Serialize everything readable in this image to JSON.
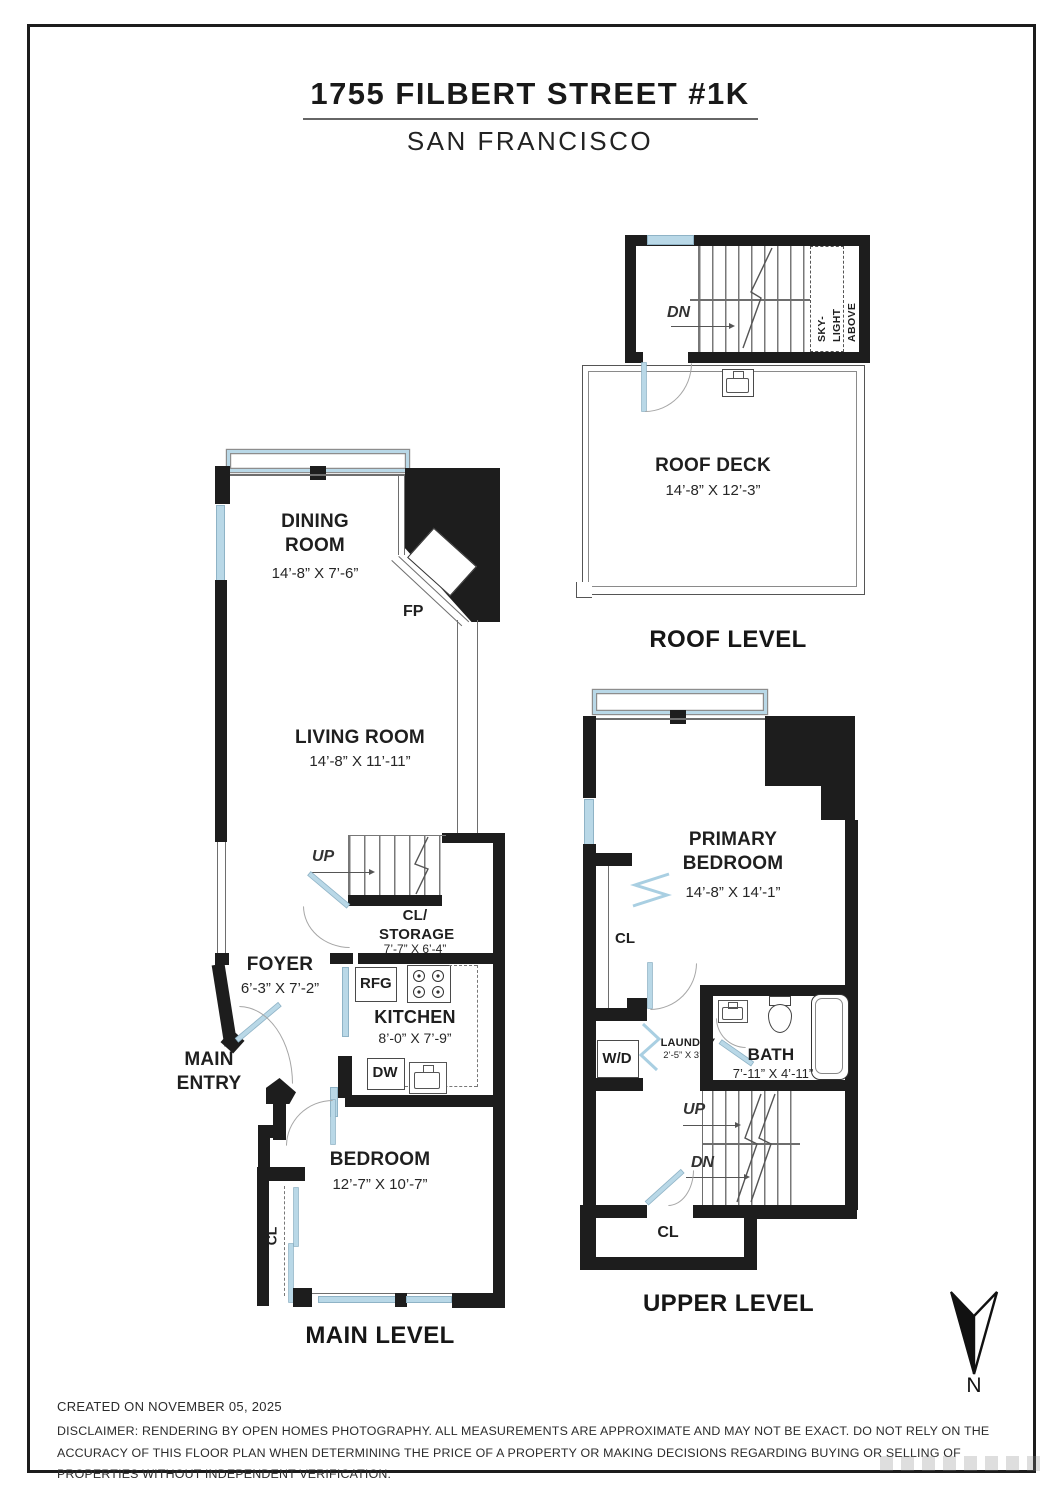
{
  "header": {
    "title": "1755 FILBERT STREET #1K",
    "subtitle": "SAN FRANCISCO"
  },
  "roof": {
    "level_label": "ROOF LEVEL",
    "deck_name": "ROOF DECK",
    "deck_dims": "14’-8” X 12’-3”",
    "dn": "DN",
    "skylight": [
      "SKY-",
      "LIGHT",
      "ABOVE"
    ]
  },
  "main": {
    "level_label": "MAIN LEVEL",
    "dining_name": "DINING ROOM",
    "dining_dims": "14’-8” X 7’-6”",
    "fp": "FP",
    "living_name": "LIVING ROOM",
    "living_dims": "14’-8” X 11’-11”",
    "up": "UP",
    "storage_name": "CL/ STORAGE",
    "storage_dims": "7’-7” X 6’-4”",
    "foyer_name": "FOYER",
    "foyer_dims": "6’-3” X 7’-2”",
    "rfg": "RFG",
    "kitchen_name": "KITCHEN",
    "kitchen_dims": "8’-0” X 7’-9”",
    "dw": "DW",
    "entry": "MAIN ENTRY",
    "bedroom_name": "BEDROOM",
    "bedroom_dims": "12’-7” X 10’-7”",
    "cl": "CL"
  },
  "upper": {
    "level_label": "UPPER LEVEL",
    "primary_name": "PRIMARY BEDROOM",
    "primary_dims": "14’-8” X 14’-1”",
    "cl_closet": "CL",
    "wd": "W/D",
    "laundry_name": "LAUNDRY",
    "laundry_dims": "2’-5” X 3’-5”",
    "bath_name": "BATH",
    "bath_dims": "7’-11” X 4’-11”",
    "up": "UP",
    "dn": "DN",
    "cl_lower": "CL"
  },
  "compass": {
    "n": "N"
  },
  "footer": {
    "created": "CREATED ON NOVEMBER 05, 2025",
    "disclaimer": "DISCLAIMER: RENDERING BY OPEN HOMES PHOTOGRAPHY. ALL MEASUREMENTS ARE APPROXIMATE AND MAY NOT BE EXACT. DO NOT RELY ON THE ACCURACY OF THIS FLOOR PLAN WHEN DETERMINING THE PRICE OF A PROPERTY OR MAKING DECISIONS REGARDING BUYING OR SELLING OF PROPERTIES WITHOUT INDEPENDENT VERIFICATION."
  },
  "colors": {
    "wall": "#1d1d1d",
    "window": "#b9d8e7",
    "thin_line": "#6e6e6e"
  }
}
